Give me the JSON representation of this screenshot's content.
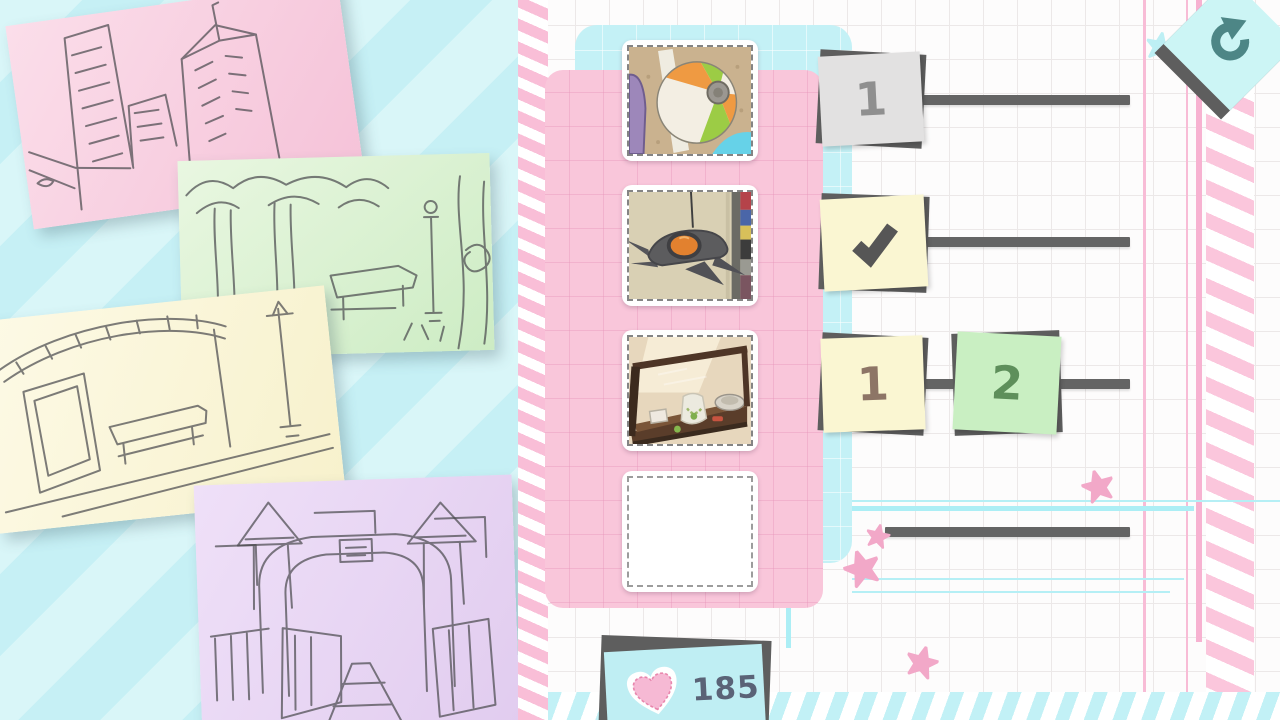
{
  "screen": "spot-the-difference-worksheet",
  "colors": {
    "paper_pink_panel": "#f9c6da",
    "paper_cyan_panel": "#c4f1f6",
    "ink_dark_gray": "#5e5e5e",
    "accent_pink": "#f2a8c8",
    "accent_cyan": "#bfeef3",
    "counter_text": "#5a6377"
  },
  "sketches": [
    {
      "paper": "pink",
      "subject": "city-buildings-sketch"
    },
    {
      "paper": "green",
      "subject": "park-trees-lamp-sketch"
    },
    {
      "paper": "cream",
      "subject": "bus-stop-shelter-sketch"
    },
    {
      "paper": "purple",
      "subject": "park-gate-arch-sketch"
    }
  ],
  "photo_slots": [
    {
      "state": "filled",
      "subject": "beach-ball-on-sand"
    },
    {
      "state": "filled",
      "subject": "toy-spaceship-hanging"
    },
    {
      "state": "filled",
      "subject": "jewelry-display-case"
    },
    {
      "state": "empty",
      "subject": ""
    }
  ],
  "progress_rows": {
    "row1": {
      "note_style": "gray",
      "label": "1"
    },
    "row2": {
      "note_style": "yellow",
      "icon": "checkmark"
    },
    "row3": {
      "note_a_style": "yellow",
      "label_a": "1",
      "note_b_style": "green",
      "label_b": "2"
    },
    "row4": {
      "note_style": "none"
    }
  },
  "hud": {
    "counter": {
      "icon": "heart",
      "value": "185"
    },
    "redo_button": {
      "icon": "redo-arrow"
    }
  }
}
